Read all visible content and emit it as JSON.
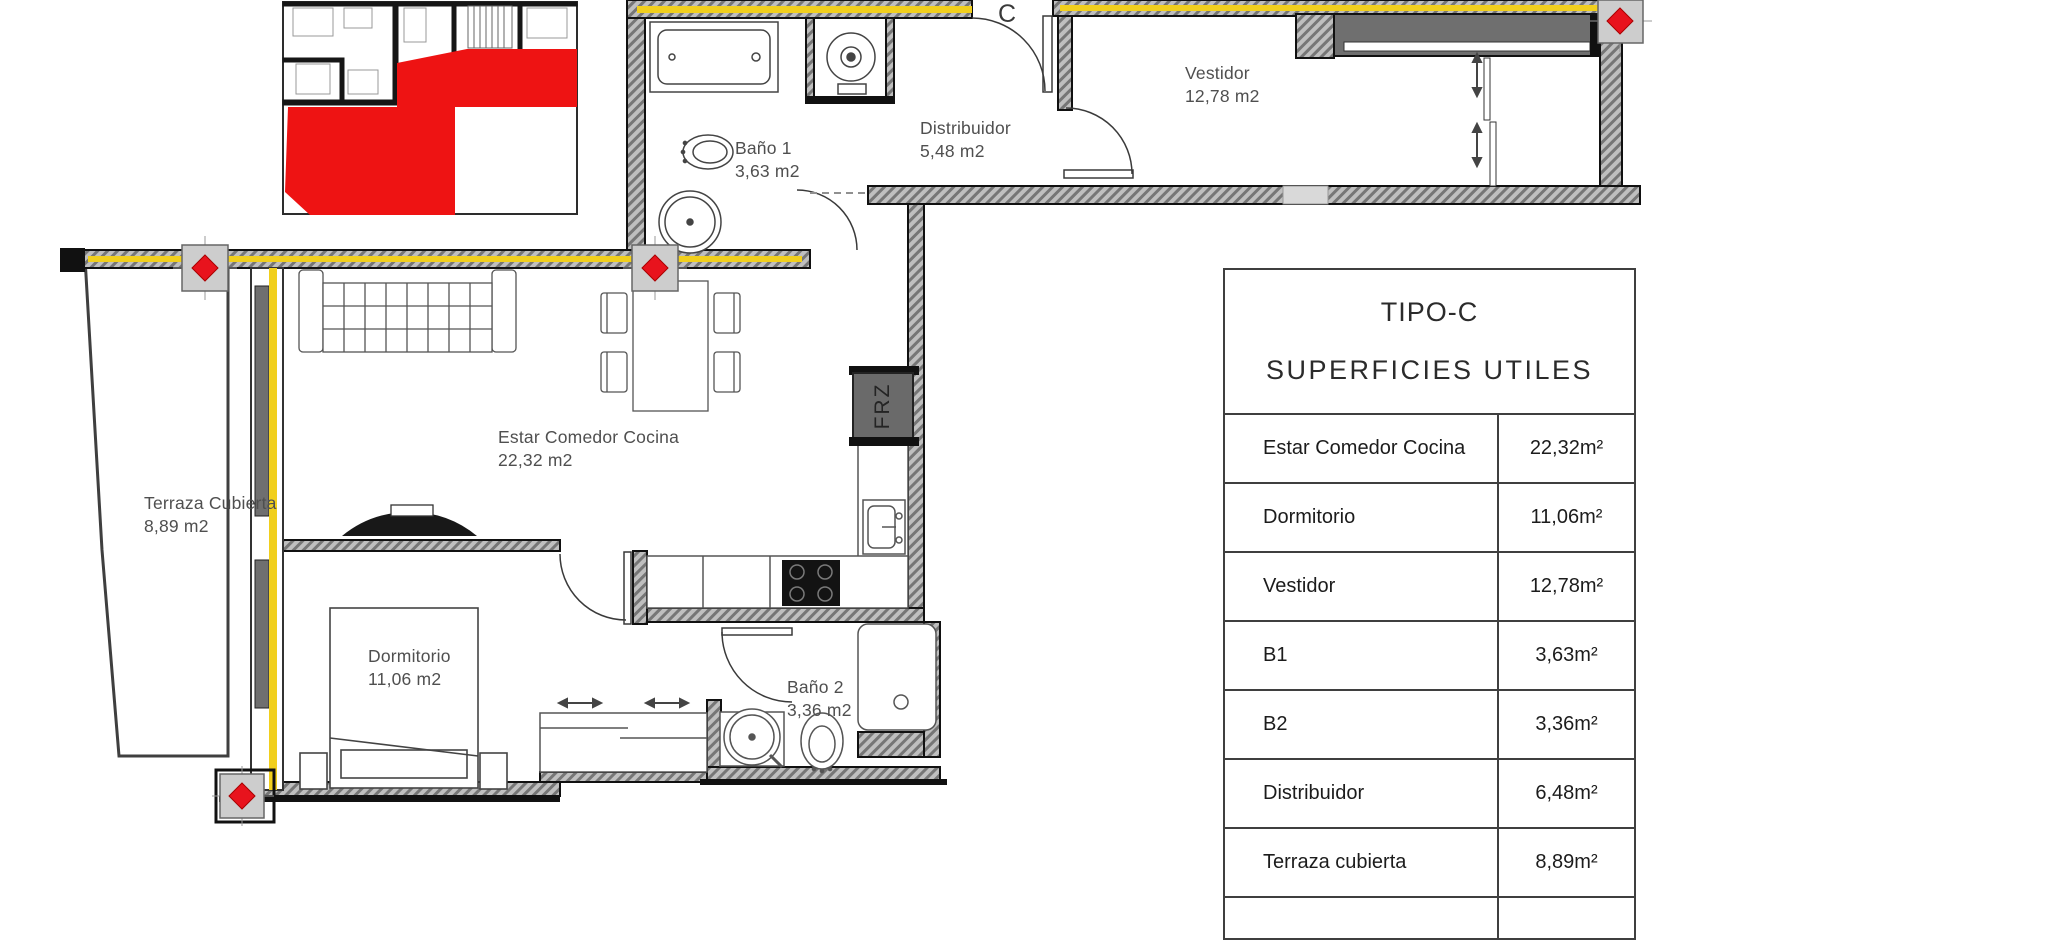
{
  "plan": {
    "entrance_label": "C",
    "appliance_label": "FRZ",
    "rooms": {
      "bano1": {
        "name": "Baño 1",
        "area": "3,63 m2"
      },
      "distribuidor": {
        "name": "Distribuidor",
        "area": "5,48 m2"
      },
      "vestidor": {
        "name": "Vestidor",
        "area": "12,78 m2"
      },
      "estar": {
        "name": "Estar Comedor Cocina",
        "area": "22,32 m2"
      },
      "terraza": {
        "name": "Terraza Cubierta",
        "area": "8,89 m2"
      },
      "dormitorio": {
        "name": "Dormitorio",
        "area": "11,06 m2"
      },
      "bano2": {
        "name": "Baño 2",
        "area": "3,36 m2"
      }
    }
  },
  "table": {
    "title": "TIPO-C",
    "subtitle": "SUPERFICIES UTILES",
    "rows": [
      {
        "label": "Estar Comedor Cocina",
        "value": "22,32m²"
      },
      {
        "label": "Dormitorio",
        "value": "11,06m²"
      },
      {
        "label": "Vestidor",
        "value": "12,78m²"
      },
      {
        "label": "B1",
        "value": "3,63m²"
      },
      {
        "label": "B2",
        "value": "3,36m²"
      },
      {
        "label": "Distribuidor",
        "value": "6,48m²"
      },
      {
        "label": "Terraza cubierta",
        "value": "8,89m²"
      }
    ]
  },
  "colors": {
    "highlight_red": "#ee1313",
    "insulation_yellow": "#f1cf1d",
    "wall_gray": "#bfbfbf",
    "glazing_gray": "#6f6f6f"
  }
}
